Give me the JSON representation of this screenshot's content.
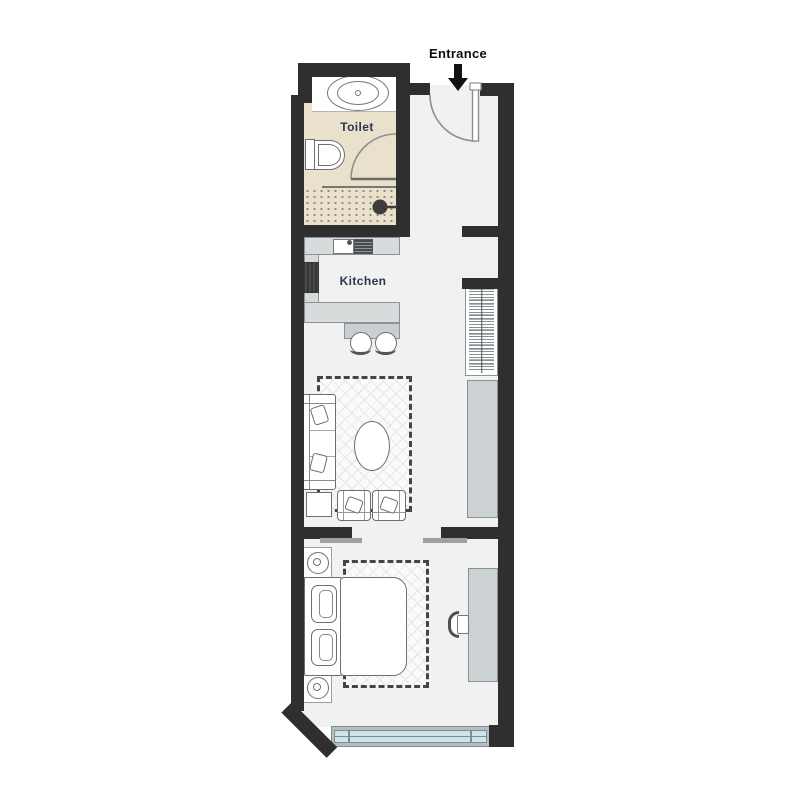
{
  "labels": {
    "entrance": "Entrance",
    "toilet": "Toilet",
    "kitchen": "Kitchen"
  },
  "colors": {
    "wall": "#2f2f2f",
    "floor": "#f1f1f1",
    "toilet-floor": "#e9e1cb",
    "counter": "#d7dbdc",
    "cabinet": "#ccd2d4",
    "window-glass": "#cfe4e8",
    "window-frame": "#b2bec1",
    "outline": "#6e6e6e",
    "room-label": "#2a3850",
    "entrance-label": "#0d0d0d"
  },
  "furniture": {
    "toilet_room": [
      "sink",
      "toilet",
      "shower",
      "door-swing"
    ],
    "kitchen": [
      "counter",
      "kitchen-sink",
      "cooktop",
      "oven",
      "island-counter",
      "bar-table",
      "bar-stool",
      "bar-stool"
    ],
    "hallway": [
      "entrance-door",
      "wardrobe"
    ],
    "living_area": [
      "sofa",
      "throw-pillows",
      "coffee-table",
      "armchair",
      "armchair",
      "side-table",
      "area-rug",
      "sideboard"
    ],
    "bedroom": [
      "double-bed",
      "pillows",
      "nightstand-with-lamp",
      "nightstand-with-lamp",
      "area-rug",
      "desk",
      "desk-chair",
      "sliding-door"
    ],
    "exterior": [
      "window",
      "entrance-arrow"
    ]
  }
}
